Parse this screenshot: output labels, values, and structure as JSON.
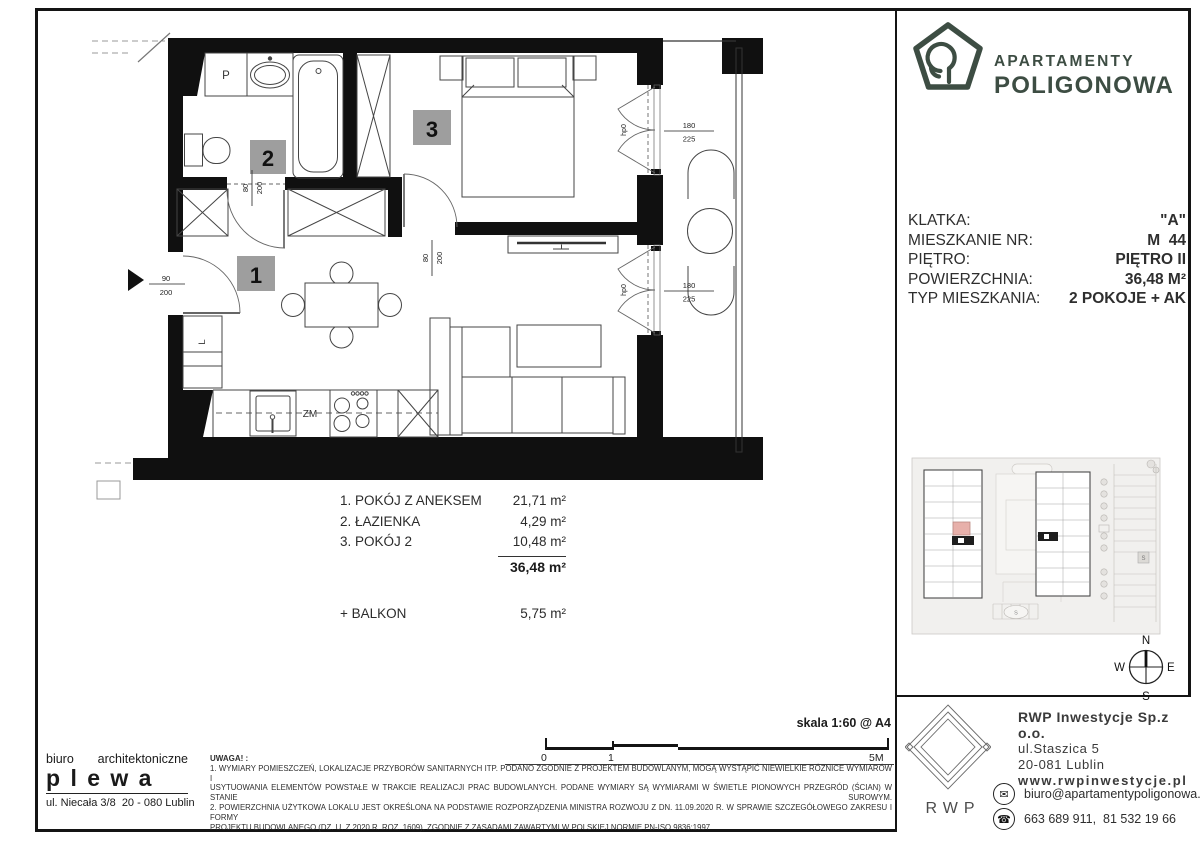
{
  "branding": {
    "line1": "APARTAMENTY",
    "line2": "POLIGONOWA",
    "color": "#3d4d43"
  },
  "info": {
    "rows": [
      {
        "label": "KLATKA:",
        "value": "\"A\""
      },
      {
        "label": "MIESZKANIE NR:",
        "value": "M  44"
      },
      {
        "label": "PIĘTRO:",
        "value": "PIĘTRO II"
      },
      {
        "label": "POWIERZCHNIA:",
        "value": "36,48 M²"
      },
      {
        "label": "TYP MIESZKANIA:",
        "value": "2 POKOJE + AK"
      }
    ]
  },
  "plan": {
    "badge1": "1",
    "badge2": "2",
    "badge3": "3",
    "washer": "P",
    "fridge": "L",
    "dishwasher": "ZM",
    "dim_entry_w": "90",
    "dim_entry_h": "200",
    "dim_door_w": "80",
    "dim_door_h": "200",
    "dim_balcony_w": "180",
    "dim_balcony_h": "225",
    "sill": "hp0"
  },
  "rooms": {
    "items": [
      {
        "label": "1. POKÓJ Z ANEKSEM",
        "area": "21,71 m²"
      },
      {
        "label": "2. ŁAZIENKA",
        "area": "4,29 m²"
      },
      {
        "label": "3. POKÓJ 2",
        "area": "10,48 m²"
      }
    ],
    "total": "36,48 m²",
    "balcony_label": "+ BALKON",
    "balcony_area": "5,75  m²"
  },
  "scalebar": {
    "title": "skala 1:60 @ A4",
    "tick0": "0",
    "tick1": "1",
    "tick5": "5M"
  },
  "notes": {
    "heading": "UWAGA! :",
    "lines": [
      "1. WYMIARY POMIESZCZEŃ, LOKALIZACJE PRZYBORÓW SANITARNYCH ITP. PODANO ZGODNIE Z PROJEKTEM BUDOWLANYM, MOGĄ WYSTĄPIĆ NIEWIELKIE RÓŻNICE WYMIARÓW I",
      "USYTUOWANIA ELEMENTÓW POWSTAŁE W TRAKCIE REALIZACJI PRAC BUDOWLANYCH. PODANE WYMIARY SĄ WYMIARAMI W ŚWIETLE PIONOWYCH PRZEGRÓD (ŚCIAN) W STANIE SUROWYM.",
      "2. POWIERZCHNIA UŻYTKOWA LOKALU JEST OKREŚLONA NA PODSTAWIE ROZPORZĄDZENIA MINISTRA ROZWOJU Z DN. 11.09.2020 R. W SPRAWIE SZCZEGÓŁOWEGO ZAKRESU I FORMY",
      "PROJEKTU BUDOWLANEGO (DZ. U. Z 2020 R. ROZ. 1609),  ZGODNIE Z ZASADAMI ZAWARTYMI W POLSKIEJ NORMIE PN-ISO 9836:1997"
    ]
  },
  "architect": {
    "word1": "biuro",
    "word2": "architektoniczne",
    "name": "p l e w a",
    "address": "ul. Niecała 3/8  20 - 080 Lublin"
  },
  "developer": {
    "logo": "RWP",
    "name": "RWP Inwestycje Sp.z o.o.",
    "street": "ul.Staszica 5",
    "city": "20-081 Lublin",
    "website": "www.rwpinwestycje.pl",
    "email": "biuro@apartamentypoligonowa.pl",
    "phones": "663 689 911,  81 532 19 66"
  },
  "compass": {
    "n": "N",
    "e": "E",
    "s": "S",
    "w": "W"
  },
  "siteplan": {
    "marker": "S"
  }
}
